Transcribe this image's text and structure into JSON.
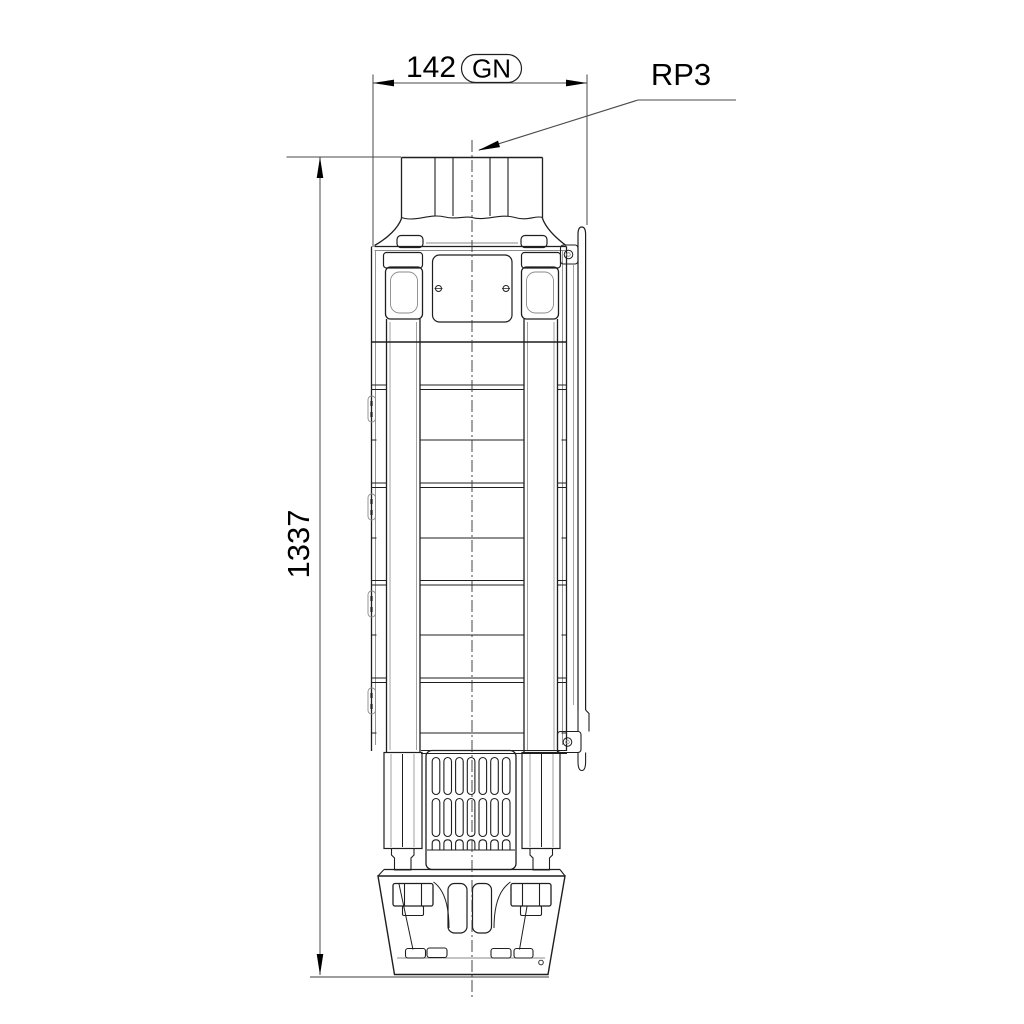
{
  "page": {
    "type": "technical-dimension-drawing",
    "subject": "submersible-borehole-pump-front-view"
  },
  "labels": {
    "width_dimension": "142",
    "width_code": "GN",
    "length_dimension": "1337",
    "connection_size": "RP3"
  },
  "colors": {
    "outline": "#1f1f1f",
    "secondary_line": "#8a8a8a",
    "dimension_line": "#4a4a4a",
    "text": "#000000",
    "background": "#ffffff"
  }
}
